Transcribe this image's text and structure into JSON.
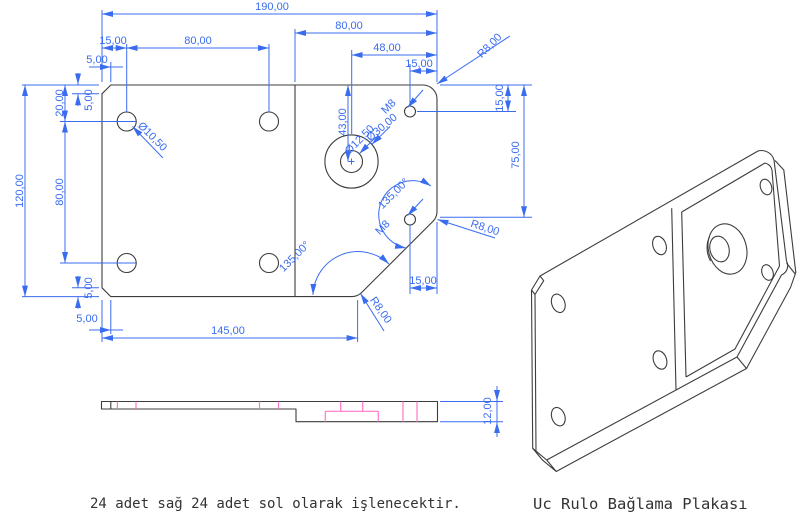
{
  "title": "Uc Rulo Bağlama Plakası",
  "note": "24 adet sağ 24 adet sol olarak işlenecektir.",
  "colors": {
    "dimension": "#3a6cf0",
    "outline": "#3d3d3d",
    "hidden": "#ff77c8",
    "text": "#333333",
    "background": "#ffffff"
  },
  "top_view": {
    "dims": {
      "total_width": "190,00",
      "right_section_width": "80,00",
      "edge_to_hole_h": "15,00",
      "hole_spacing_h": "80,00",
      "bore_to_edge": "48,00",
      "chamfer_top_h": "5,00",
      "m8_to_edge": "15,00",
      "radius_top_right": "R8,00",
      "chamfer_top_v": "5,00",
      "top_to_hole_v": "20,00",
      "hole_spacing_v": "80,00",
      "total_height": "120,00",
      "chamfer_bottom_v": "5,00",
      "chamfer_bottom_h": "5,00",
      "bottom_width": "145,00",
      "top_to_m8_v": "15,00",
      "top_to_corner_v": "75,00",
      "top_to_bore_v": "43,00",
      "bore_inner_dia": "Ø12,50",
      "bore_outer_dia": "Ø30,00",
      "m8_top_label": "M8",
      "m8_diag_label": "M8",
      "angle_upper": "135,00°",
      "angle_lower": "135,00°",
      "m8_diag_offset": "15,00",
      "radius_right": "R8,00",
      "radius_bottom": "R8,00",
      "corner_hole_dia": "Ø10,50"
    }
  },
  "side_view": {
    "dims": {
      "thickness": "12,00"
    }
  }
}
